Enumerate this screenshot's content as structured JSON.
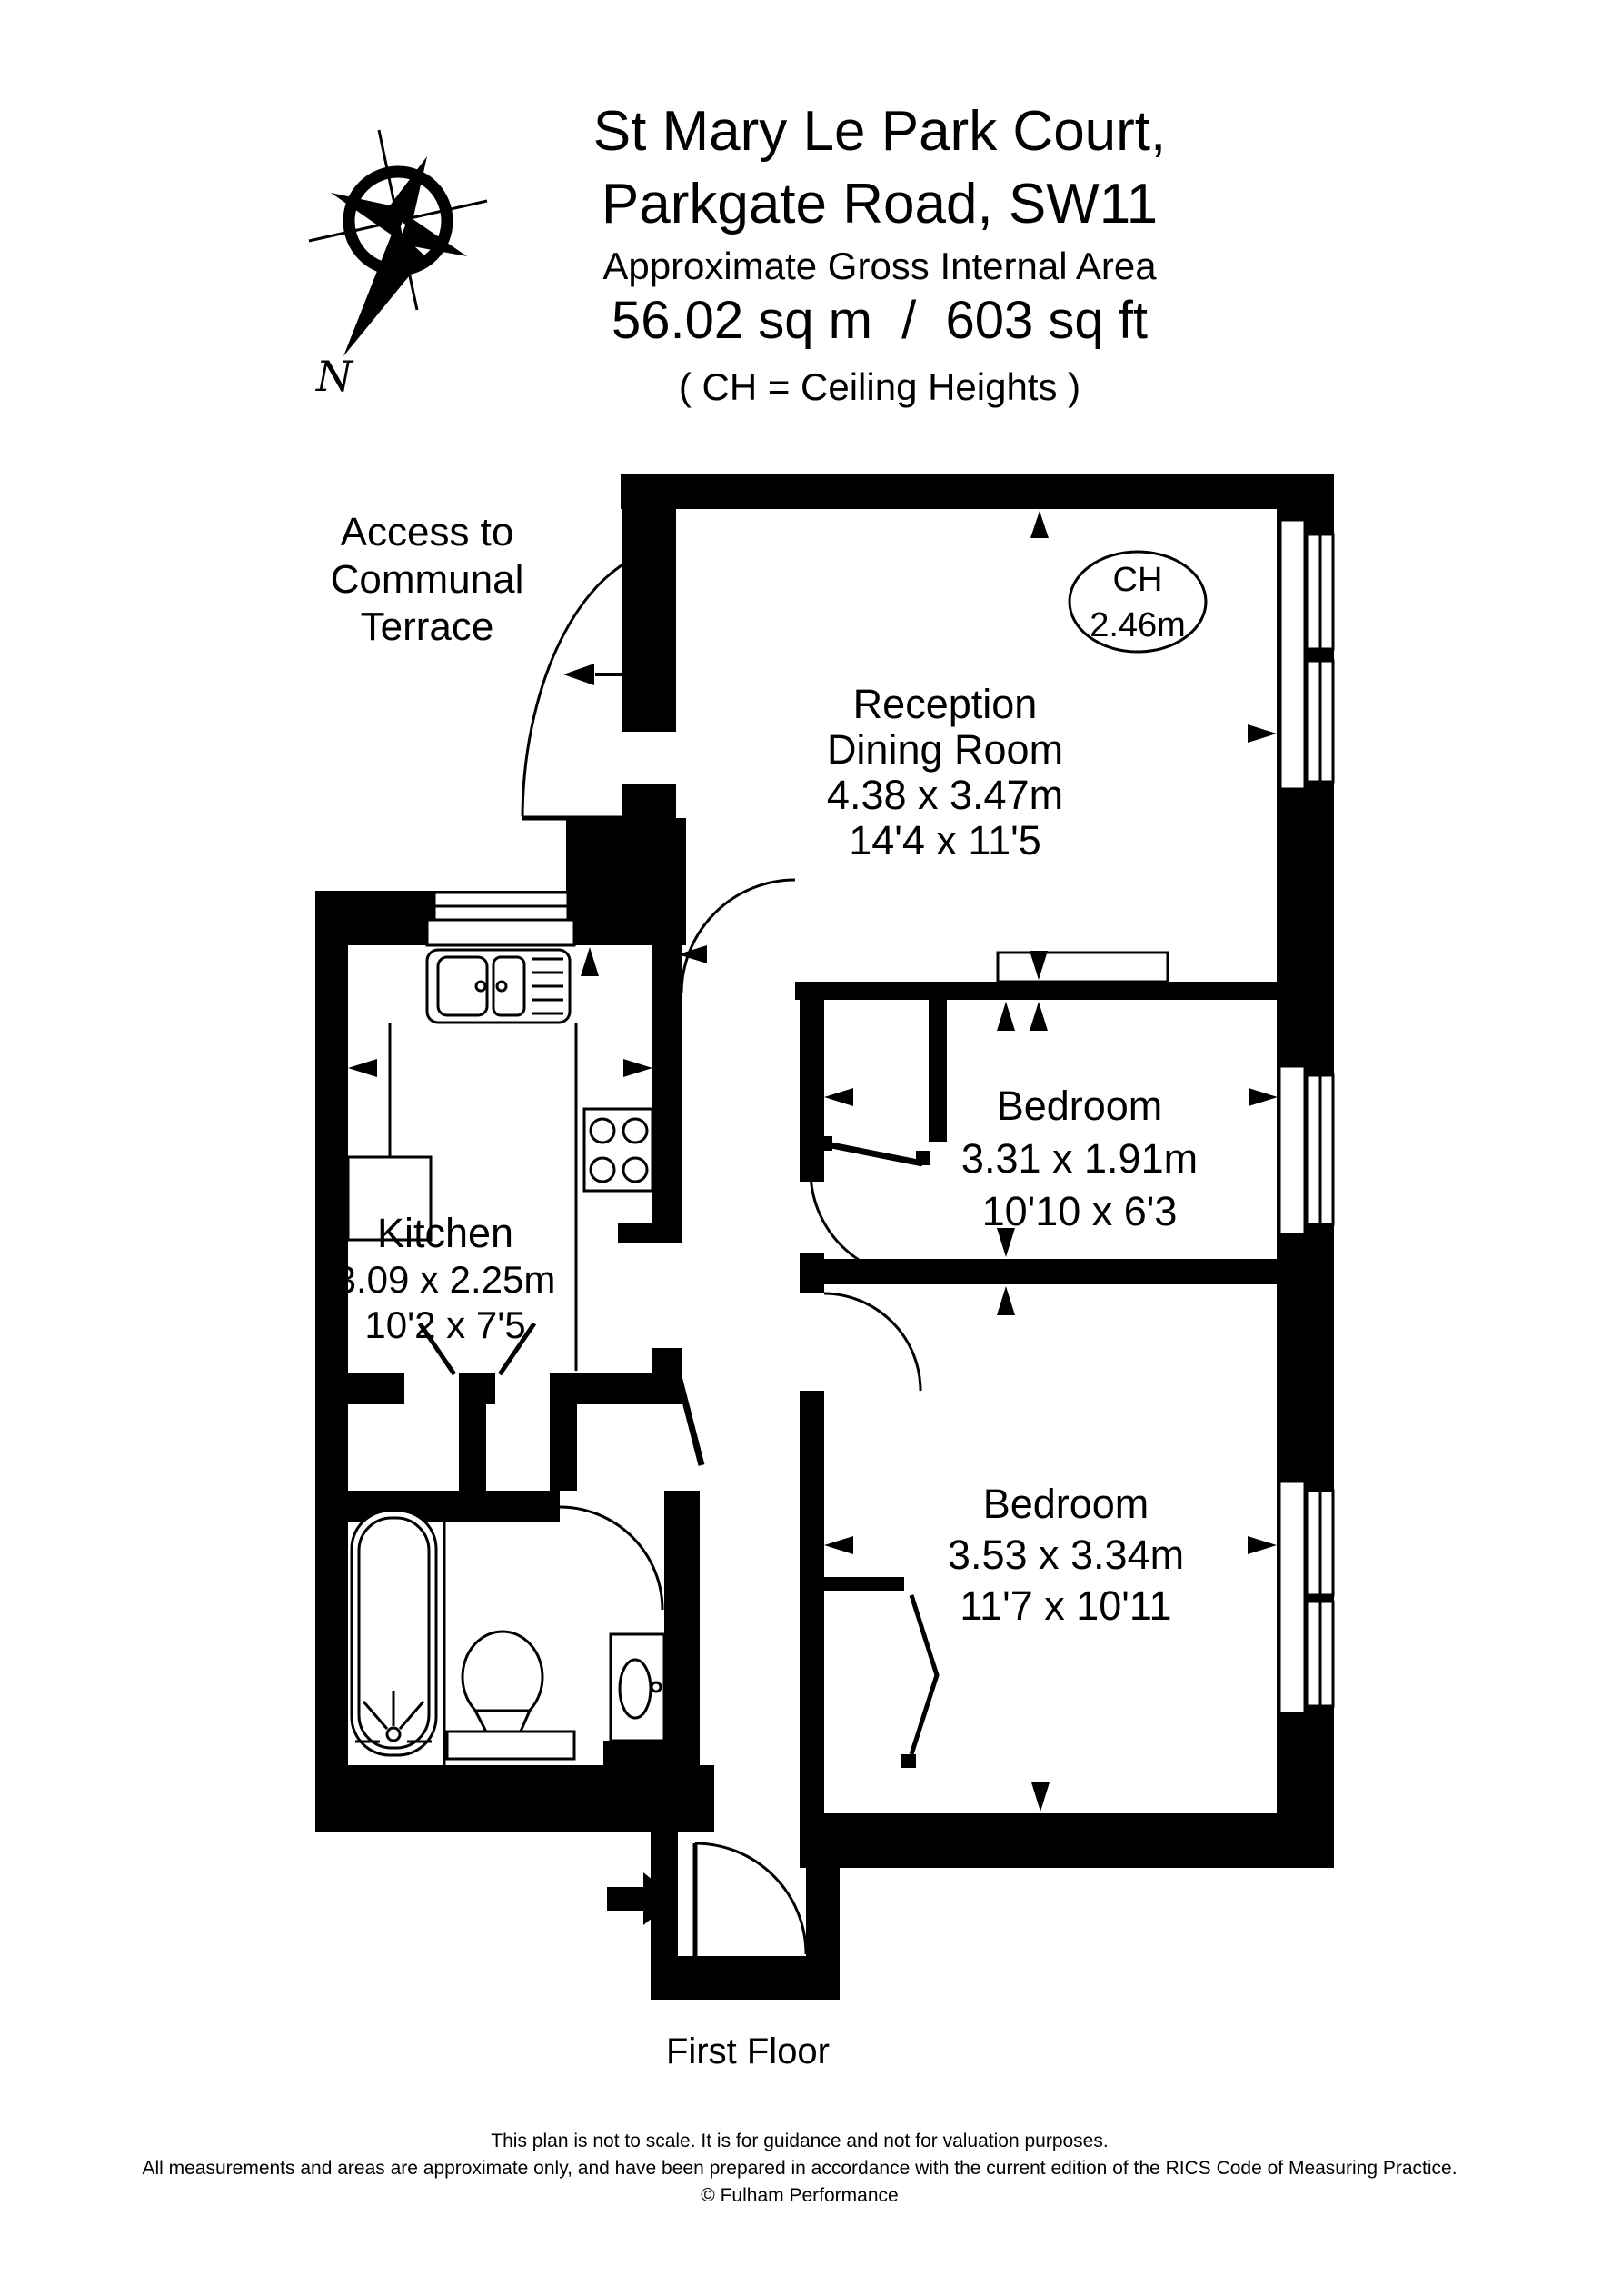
{
  "header": {
    "line1": "St Mary Le Park Court,",
    "line2": "Parkgate Road, SW11",
    "subtitle": "Approximate Gross Internal Area",
    "area": "56.02 sq m  /  603 sq ft",
    "ch_note": "( CH = Ceiling Heights )"
  },
  "compass": {
    "label": "N"
  },
  "ceiling_badge": {
    "line1": "CH",
    "line2": "2.46m"
  },
  "access_label": {
    "line1": "Access to",
    "line2": "Communal",
    "line3": "Terrace"
  },
  "rooms": {
    "reception": {
      "name1": "Reception",
      "name2": "Dining Room",
      "metric": "4.38 x 3.47m",
      "imperial": "14'4 x 11'5"
    },
    "kitchen": {
      "name": "Kitchen",
      "metric": "3.09 x 2.25m",
      "imperial": "10'2 x 7'5"
    },
    "bedroom_small": {
      "name": "Bedroom",
      "metric": "3.31 x 1.91m",
      "imperial": "10'10 x 6'3"
    },
    "bedroom_large": {
      "name": "Bedroom",
      "metric": "3.53 x 3.34m",
      "imperial": "11'7 x 10'11"
    }
  },
  "floor_label": "First Floor",
  "footer": {
    "line1": "This plan is not to scale. It is for guidance and not for valuation purposes.",
    "line2": "All measurements and areas are approximate only, and have been prepared in accordance with the current edition of the RICS Code of Measuring Practice.",
    "line3": "© Fulham Performance"
  },
  "colors": {
    "ink": "#000000",
    "paper": "#ffffff"
  }
}
